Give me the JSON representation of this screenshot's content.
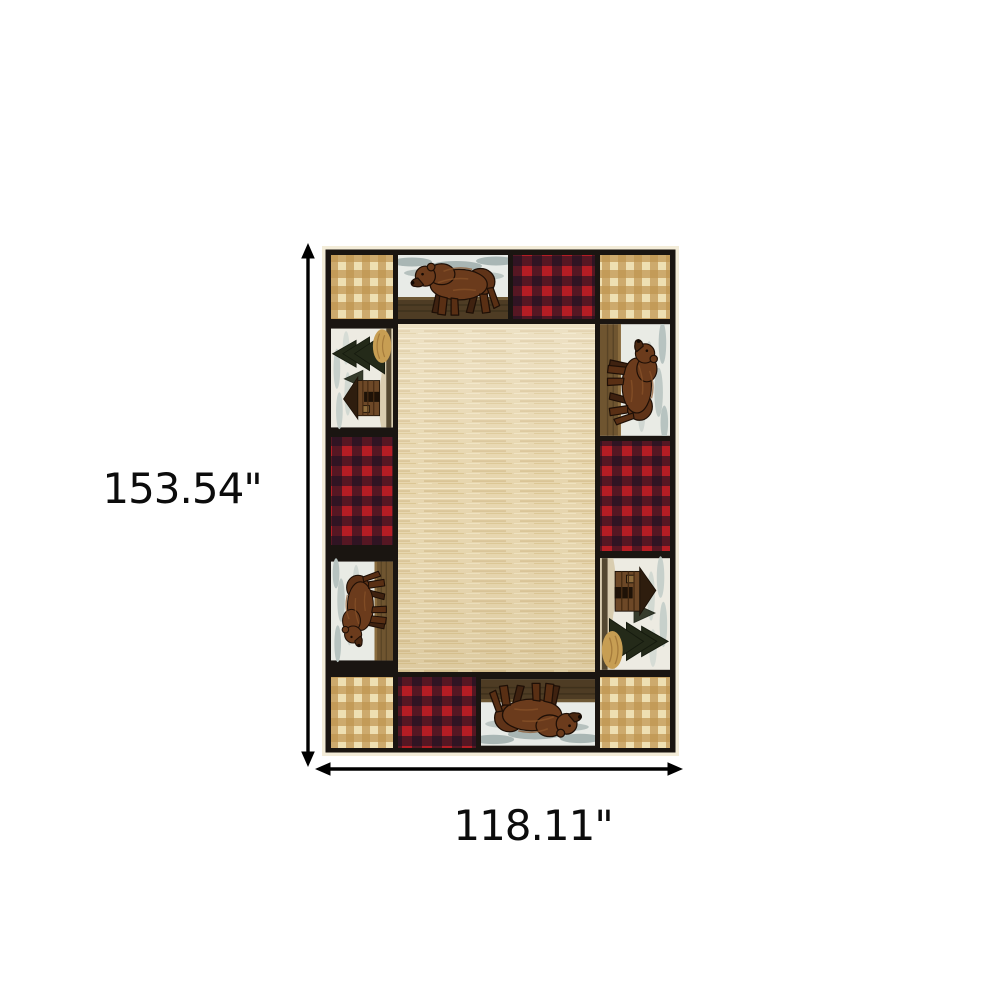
{
  "page": {
    "background": "#ffffff"
  },
  "product": {
    "name": "lodge-bear-patchwork-area-rug",
    "description": "Rectangular lodge-style area rug: beige woven center field surrounded by a patchwork border of walking-bear panels, log-cabin scenes, red buffalo-check squares and tan gingham corner squares, separated by black grid lines"
  },
  "dimensions": {
    "height_label": "153.54\"",
    "width_label": "118.11\"",
    "height_value": 153.54,
    "width_value": 118.11,
    "unit": "inches"
  },
  "colors": {
    "arrow": "#000000",
    "label_text": "#0c0c0c",
    "grid_black": "#1a1511",
    "fringe_cream": "#f3ecd8",
    "center_field": "#e7d6ae",
    "gingham_cream": "#eedfb2",
    "gingham_tan": "#bf9450",
    "buffalo_red": "#b51d24",
    "buffalo_black": "#181323",
    "bear_brown": "#6b3b1c",
    "sky_gray": "#a9b6b4",
    "ground_olive": "#4e3c24",
    "cabin_brown": "#6d4827",
    "tree_dark": "#242a19",
    "hay_tan": "#c79e53"
  }
}
